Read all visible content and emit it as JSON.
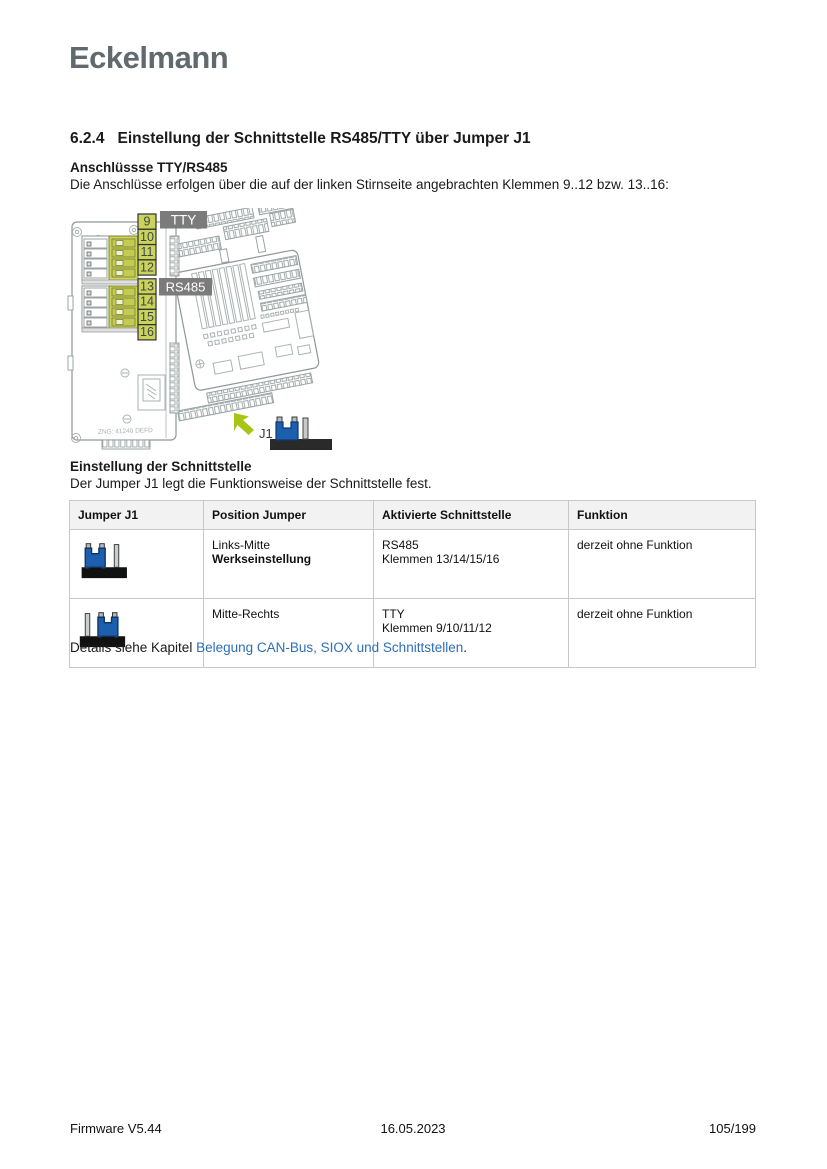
{
  "page": {
    "logo": "Eckelmann",
    "logo_color": "#60696d",
    "link_color": "#2e6fb7"
  },
  "section": {
    "number": "6.2.4",
    "title": "Einstellung der Schnittstelle RS485/TTY über Jumper J1"
  },
  "anschluesse": {
    "heading": "Anschlüssse TTY/RS485",
    "body": "Die Anschlüsse erfolgen über die auf der linken Stirnseite angebrachten Klemmen 9..12 bzw. 13..16:"
  },
  "diagram": {
    "terminal_numbers": [
      "9",
      "10",
      "11",
      "12",
      "13",
      "14",
      "15",
      "16"
    ],
    "label_tty": "TTY",
    "label_rs485": "RS485",
    "board_text": "ZNG: 41240 DEFD",
    "jumper_label": "J1",
    "colors": {
      "highlight_green": "#cbd35b",
      "label_gray": "#7b7b7b",
      "jumper_blue": "#1d5fae",
      "arrow_green": "#a6c515",
      "lineart_gray": "#9aa3a3"
    }
  },
  "einstellung": {
    "heading": "Einstellung der Schnittstelle",
    "body": "Der Jumper J1 legt die Funktionsweise der Schnittstelle fest."
  },
  "table": {
    "headers": [
      "Jumper J1",
      "Position Jumper",
      "Aktivierte Schnittstelle",
      "Funktion"
    ],
    "rows": [
      {
        "jumper_variant": "links-mitte",
        "position": "Links-Mitte",
        "position_bold": "Werkseinstellung",
        "schnittstelle_line1": "RS485",
        "schnittstelle_line2": "Klemmen 13/14/15/16",
        "funktion": "derzeit ohne Funktion"
      },
      {
        "jumper_variant": "mitte-rechts",
        "position": "Mitte-Rechts",
        "position_bold": "",
        "schnittstelle_line1": "TTY",
        "schnittstelle_line2": "Klemmen 9/10/11/12",
        "funktion": "derzeit ohne Funktion"
      }
    ]
  },
  "details": {
    "prefix": "Details siehe Kapitel ",
    "link": "Belegung CAN-Bus, SIOX und Schnittstellen",
    "suffix": "."
  },
  "footer": {
    "left": "Firmware V5.44",
    "center": "16.05.2023",
    "right": "105/199"
  }
}
